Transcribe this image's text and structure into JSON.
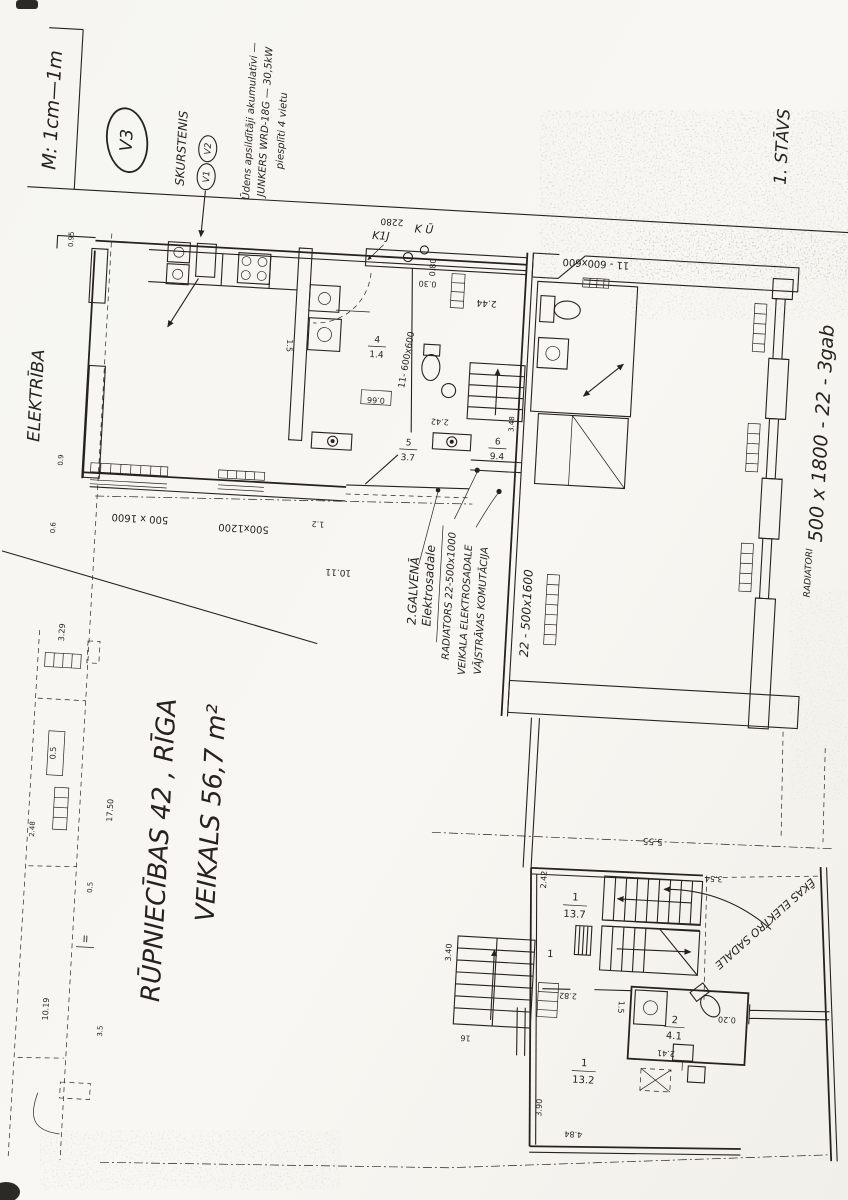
{
  "margin": {
    "scale": "M: 1cm—1m",
    "version": "V3",
    "floor": "1. STĀVS",
    "electricity": "ELEKTRĪBA"
  },
  "title": {
    "line1": "RŪPNIECĪBAS 42 , RĪGA",
    "line2": "VEIKALS 56,7 m²"
  },
  "chimney": {
    "label": "SKURSTENIS",
    "v1": "V1",
    "v2": "V2"
  },
  "heater": {
    "l1": "Ūdens apsildītāji akumulatīvi —",
    "l2": "JUNKERS WRD-18G — 30,5kW",
    "l3": "piesplīti 4 vietu"
  },
  "electro": {
    "main1": "2.GALVENĀ",
    "main2": "Elektrosadale",
    "radiator": "RADIATORS 22-500x1000",
    "shop": "VEIKALA ELEKTROSADALE",
    "lowcurrent": "VĀJSTRĀVAS KOMUTĀCIJA",
    "building": "ĒKAS ELEKTRO SADALE"
  },
  "radiators": {
    "left": "22 - 500x1600",
    "right1": "RADIATORI",
    "right2": "500 x 1800 - 22 - 3gab",
    "wc1": "22",
    "wc2": "600x600"
  },
  "windows": {
    "w1": "500 x 1600",
    "w2": "500x1200",
    "top": "11 - 600x600",
    "side": "11- 600x600"
  },
  "risers": {
    "k1": "K1J",
    "k2": "K Ū"
  },
  "rooms": [
    {
      "num": "5",
      "area": "3.7"
    },
    {
      "num": "6",
      "area": "9.4"
    },
    {
      "num": "4",
      "area": "1.4"
    },
    {
      "num": "1",
      "area": "13.7"
    },
    {
      "num": "1",
      "area": "13.2"
    },
    {
      "num": "2",
      "area": "4.1"
    }
  ],
  "simple": {
    "r1": "1",
    "closet": "1.5",
    "closet2": "1.5",
    "corridor": "2.44",
    "hall": "10.11"
  },
  "dims": {
    "a2280": "2280",
    "a030": "0.30",
    "a080": "0.80",
    "a066": "0.66",
    "a242w": "2.42",
    "a348": "3.48",
    "a555": "5.55",
    "a354": "3.54",
    "a340": "3.40",
    "a16": "16",
    "a282": "2.82",
    "a241": "2.41",
    "a020": "0.20",
    "a390": "3.90",
    "a484": "4.84",
    "a12": "1.2",
    "a090": "0.9",
    "a060": "0.6",
    "a095": "0.95",
    "a242s": "2.42",
    "a329": "3.29",
    "a05": "0.5",
    "a1750": "17.50",
    "a248": "2.48",
    "a05b": "0.5",
    "a1019": "10.19",
    "a35": "3.5",
    "aII": "II"
  }
}
